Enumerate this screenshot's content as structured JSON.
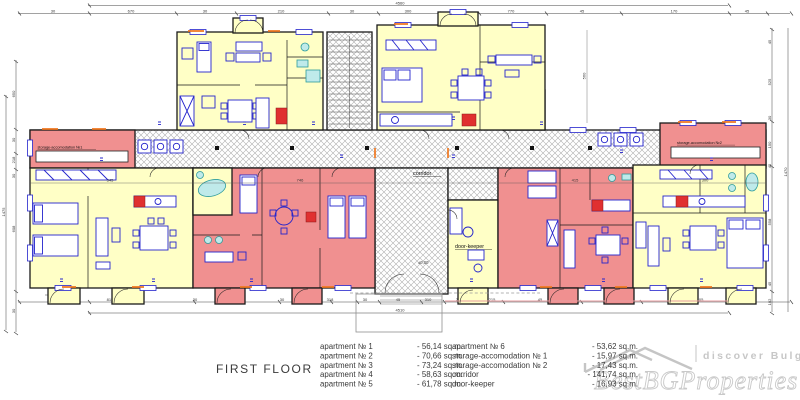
{
  "plan": {
    "labels": {
      "corridor": "corridor",
      "door_keeper": "door-keeper",
      "storage1": "storage-accomodation №1",
      "storage2": "storage-accomodation №2",
      "level_mark": "±0,00"
    },
    "colors": {
      "room_yellow": "#FFFFC6",
      "room_red": "#F09090",
      "furniture_blue": "#2424CC",
      "fixture_cyan": "#BFEAEA",
      "accent_orange": "#F07820",
      "stove_red": "#E03030",
      "hatch_gray": "#ADADAD",
      "watermark_gray": "#C9C9C9"
    }
  },
  "dims": {
    "top_total": "4560",
    "bottom_total": "4510",
    "left_total": "1475",
    "right_total": "1470",
    "door": "200",
    "top": [
      "30",
      "670",
      "30",
      "210",
      "30",
      "300",
      "45",
      "770",
      "45",
      "170",
      "45"
    ],
    "bottom": [
      "815",
      "30",
      "265",
      "30",
      "318",
      "30",
      "45",
      "310",
      "25",
      "215",
      "45",
      "150",
      "205"
    ],
    "left": [
      "650",
      "30",
      "218",
      "30",
      "608",
      "30"
    ],
    "right": [
      "45",
      "525",
      "30",
      "150",
      "45",
      "558",
      "45",
      "102"
    ],
    "inner": [
      "560",
      "345",
      "746",
      "415",
      "300"
    ]
  },
  "legend": {
    "title": "FIRST FLOOR",
    "col1": [
      {
        "label": "apartment № 1",
        "value": "- 56,14 sq.m."
      },
      {
        "label": "apartment № 2",
        "value": "- 70,66 sq.m."
      },
      {
        "label": "apartment № 3",
        "value": "- 73,24 sq.m."
      },
      {
        "label": "apartment № 4",
        "value": "- 58,63 sq.m."
      },
      {
        "label": "apartment № 5",
        "value": "- 61,78 sq.m."
      }
    ],
    "col2": [
      {
        "label": "apartment № 6",
        "value": "- 53,62 sq.m."
      },
      {
        "label": "storage-accomodation  № 1",
        "value": "- 15,97 sq.m."
      },
      {
        "label": "storage-accomodation  № 2",
        "value": "- 17,43 sq.m."
      },
      {
        "label": "corridor",
        "value": "- 141,74 sq.m."
      },
      {
        "label": "door-keeper",
        "value": "- 16,93 sq.m."
      }
    ]
  },
  "watermark": {
    "tagline": "discover Bulgaria",
    "brand": "BestBGProperties"
  }
}
